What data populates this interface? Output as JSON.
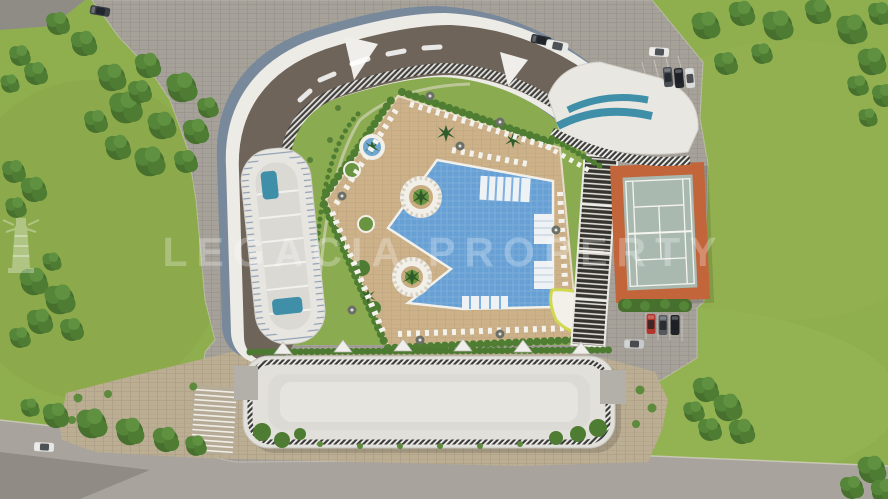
{
  "title": "Aerial 3D site-plan rendering of a residential resort complex",
  "watermark": {
    "left_word": "LEGACIA",
    "right_word": "PROPERTY",
    "icon": "lighthouse-icon"
  },
  "scene": {
    "view": "top-down aerial rendering",
    "palette": {
      "grass": "#8fae4e",
      "tree_green": "#4e7c33",
      "hedge_green": "#4c7a30",
      "road_gray": "#a8a49d",
      "plaza_gray": "#a6a29a",
      "plaza_beige": "#bcae93",
      "deck_tan": "#ccb189",
      "pool_blue": "#66a0d4",
      "roof_dark_taupe": "#6e6459",
      "facade_blue_gray": "#76889c",
      "building_white": "#edebe6",
      "glass_teal": "#3f8fa8",
      "court_border_orange": "#c2653a",
      "court_surface": "#a9b9b0",
      "car_red": "#b3362e"
    },
    "amenities": [
      "curved apartment building",
      "terraced tower with plunge pools",
      "landscaped courtyard garden",
      "free-form swimming pool with in-water platforms",
      "sun deck with loungers and palm islands",
      "slatted pergola",
      "tennis court",
      "low garage-roof building with railings",
      "parking areas",
      "perimeter lawn with trees",
      "access road"
    ],
    "vehicles": {
      "top_parking_cars": 6,
      "bottom_parking_cars": 4,
      "road_cars": 1,
      "corner_cars": 1
    }
  }
}
